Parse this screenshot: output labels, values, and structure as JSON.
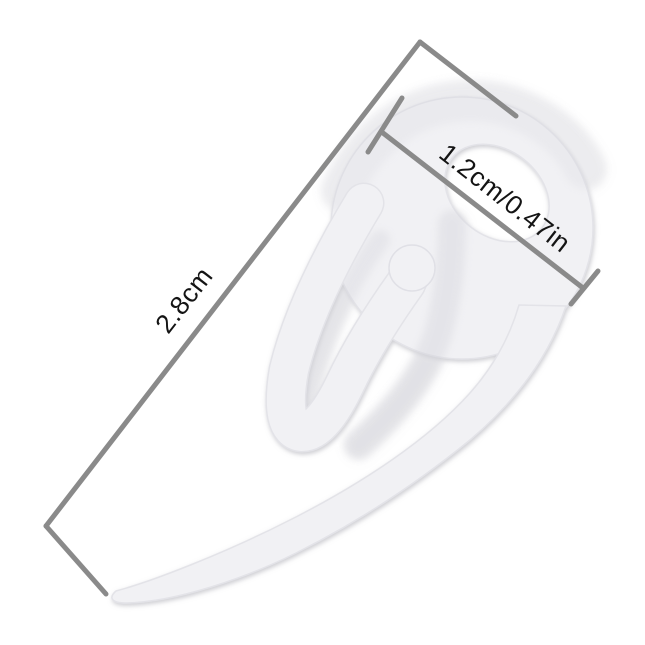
{
  "image": {
    "subject": "white plastic curtain pleat hook with size annotations",
    "canvas": "645 x 645"
  },
  "annotations": {
    "length_label": "2.8cm",
    "width_label": "1.2cm/0.47in"
  },
  "colors": {
    "background": "#ffffff",
    "dimension_line": "#8a8a8a",
    "label_text": "#141414",
    "hook_fill": "#f1f1f4",
    "hook_edge": "#e3e3e8"
  }
}
